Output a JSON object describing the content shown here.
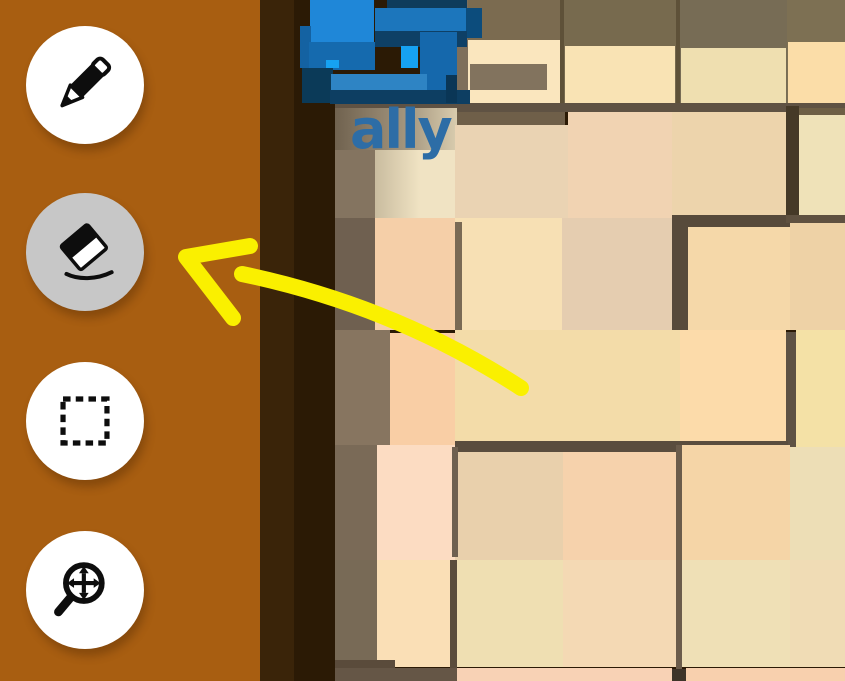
{
  "app": {
    "title": "Drawing overlay on voxel game"
  },
  "sidebar": {
    "bg": "#A85E11",
    "button_bg": "#FFFFFF",
    "active_button_bg": "#C7C7C7",
    "icon_color": "#0D0D0D",
    "tools": [
      {
        "id": "pencil",
        "label": "Draw",
        "active": false,
        "top": 26
      },
      {
        "id": "eraser",
        "label": "Erase",
        "active": true,
        "top": 193
      },
      {
        "id": "select",
        "label": "Select",
        "active": false,
        "top": 362
      },
      {
        "id": "zoom-pan",
        "label": "Zoom / Pan",
        "active": false,
        "top": 531
      }
    ]
  },
  "scene": {
    "bg": "#2B1A05",
    "player": {
      "name": "ally",
      "name_color": "#2D6DA6"
    },
    "terrain_blocks": [
      {
        "x": 260,
        "y": 0,
        "w": 34,
        "h": 681,
        "c": "#3A2409"
      },
      {
        "x": 294,
        "y": 0,
        "w": 41,
        "h": 681,
        "c": "#2B1A05"
      },
      {
        "x": 455,
        "y": 0,
        "w": 105,
        "h": 103,
        "c": "#7B6B50"
      },
      {
        "x": 560,
        "y": 0,
        "w": 116,
        "h": 103,
        "c": "#776A4E"
      },
      {
        "x": 676,
        "y": 0,
        "w": 111,
        "h": 103,
        "c": "#776C55"
      },
      {
        "x": 787,
        "y": 0,
        "w": 58,
        "h": 103,
        "c": "#7D7053"
      },
      {
        "x": 560,
        "y": 0,
        "w": 4,
        "h": 103,
        "c": "#5E5138"
      },
      {
        "x": 676,
        "y": 0,
        "w": 4,
        "h": 103,
        "c": "#5E5138"
      },
      {
        "x": 457,
        "y": 0,
        "w": 11,
        "h": 103,
        "c": "#7E6F5B"
      },
      {
        "x": 468,
        "y": 40,
        "w": 92,
        "h": 63,
        "c": "#FAE6BE"
      },
      {
        "x": 470,
        "y": 64,
        "w": 77,
        "h": 26,
        "c": "#82735E"
      },
      {
        "x": 565,
        "y": 46,
        "w": 110,
        "h": 57,
        "c": "#F9E3B4"
      },
      {
        "x": 681,
        "y": 48,
        "w": 105,
        "h": 55,
        "c": "#EFDFB0"
      },
      {
        "x": 788,
        "y": 42,
        "w": 57,
        "h": 64,
        "c": "#FBDDA8"
      },
      {
        "x": 335,
        "y": 103,
        "w": 510,
        "h": 9,
        "c": "#5F5243"
      },
      {
        "x": 455,
        "y": 112,
        "w": 110,
        "h": 13,
        "c": "#6F5F49"
      },
      {
        "x": 335,
        "y": 108,
        "w": 122,
        "h": 47,
        "c": "linear-gradient(90deg,#70624F,#A5977F 60%,#D9CCAE)"
      },
      {
        "x": 335,
        "y": 150,
        "w": 40,
        "h": 68,
        "c": "#847460"
      },
      {
        "x": 375,
        "y": 150,
        "w": 82,
        "h": 68,
        "c": "linear-gradient(90deg,#C9BC9F,#F0E3C3 55%)"
      },
      {
        "x": 455,
        "y": 125,
        "w": 113,
        "h": 93,
        "c": "#EAD3B3"
      },
      {
        "x": 568,
        "y": 112,
        "w": 104,
        "h": 106,
        "c": "#F1D3B2"
      },
      {
        "x": 672,
        "y": 112,
        "w": 114,
        "h": 106,
        "c": "#EDD4AC"
      },
      {
        "x": 786,
        "y": 106,
        "w": 13,
        "h": 116,
        "c": "#453927"
      },
      {
        "x": 799,
        "y": 108,
        "w": 46,
        "h": 7,
        "c": "#6E5F45"
      },
      {
        "x": 799,
        "y": 115,
        "w": 46,
        "h": 103,
        "c": "#EFE2B8"
      },
      {
        "x": 335,
        "y": 218,
        "w": 40,
        "h": 112,
        "c": "#6F6050"
      },
      {
        "x": 375,
        "y": 218,
        "w": 80,
        "h": 112,
        "c": "#F5CFA8"
      },
      {
        "x": 455,
        "y": 218,
        "w": 107,
        "h": 112,
        "c": "#F7E0B4"
      },
      {
        "x": 455,
        "y": 222,
        "w": 7,
        "h": 108,
        "c": "#7A6A55"
      },
      {
        "x": 562,
        "y": 218,
        "w": 110,
        "h": 112,
        "c": "#E5CDB0"
      },
      {
        "x": 672,
        "y": 215,
        "w": 16,
        "h": 118,
        "c": "#574A3B"
      },
      {
        "x": 676,
        "y": 215,
        "w": 117,
        "h": 12,
        "c": "#574A3B"
      },
      {
        "x": 688,
        "y": 227,
        "w": 102,
        "h": 103,
        "c": "#F5D8A9"
      },
      {
        "x": 786,
        "y": 215,
        "w": 59,
        "h": 8,
        "c": "#5F5140"
      },
      {
        "x": 790,
        "y": 223,
        "w": 55,
        "h": 107,
        "c": "#EED2A6"
      },
      {
        "x": 335,
        "y": 330,
        "w": 55,
        "h": 115,
        "c": "#877560"
      },
      {
        "x": 390,
        "y": 333,
        "w": 65,
        "h": 112,
        "c": "#F9CEA5"
      },
      {
        "x": 455,
        "y": 330,
        "w": 225,
        "h": 115,
        "c": "#F3DCA9"
      },
      {
        "x": 680,
        "y": 330,
        "w": 106,
        "h": 114,
        "c": "#FCDBAA"
      },
      {
        "x": 786,
        "y": 332,
        "w": 10,
        "h": 120,
        "c": "#5E5244"
      },
      {
        "x": 796,
        "y": 330,
        "w": 49,
        "h": 117,
        "c": "#F4E1A6"
      },
      {
        "x": 455,
        "y": 441,
        "w": 333,
        "h": 11,
        "c": "#5A4D3E"
      },
      {
        "x": 335,
        "y": 445,
        "w": 42,
        "h": 115,
        "c": "#7A6A57"
      },
      {
        "x": 377,
        "y": 445,
        "w": 78,
        "h": 115,
        "c": "#FCDCC2"
      },
      {
        "x": 455,
        "y": 452,
        "w": 108,
        "h": 108,
        "c": "#E9D0AC"
      },
      {
        "x": 563,
        "y": 452,
        "w": 117,
        "h": 108,
        "c": "#F6D2AC"
      },
      {
        "x": 682,
        "y": 445,
        "w": 108,
        "h": 115,
        "c": "#F5D5A7"
      },
      {
        "x": 790,
        "y": 447,
        "w": 55,
        "h": 113,
        "c": "#EDDEB6"
      },
      {
        "x": 452,
        "y": 447,
        "w": 6,
        "h": 110,
        "c": "#6F6050"
      },
      {
        "x": 676,
        "y": 445,
        "w": 6,
        "h": 227,
        "c": "#6B5C4B"
      },
      {
        "x": 335,
        "y": 560,
        "w": 42,
        "h": 107,
        "c": "#786A56"
      },
      {
        "x": 377,
        "y": 560,
        "w": 78,
        "h": 107,
        "c": "#FADFB6"
      },
      {
        "x": 450,
        "y": 560,
        "w": 7,
        "h": 108,
        "c": "#5A4D3C"
      },
      {
        "x": 457,
        "y": 560,
        "w": 106,
        "h": 107,
        "c": "#EFDFB2"
      },
      {
        "x": 563,
        "y": 560,
        "w": 113,
        "h": 107,
        "c": "#F4D9B4"
      },
      {
        "x": 682,
        "y": 560,
        "w": 108,
        "h": 107,
        "c": "#EFE0B6"
      },
      {
        "x": 790,
        "y": 560,
        "w": 55,
        "h": 107,
        "c": "#F0DCB5"
      },
      {
        "x": 335,
        "y": 660,
        "w": 60,
        "h": 21,
        "c": "#5A4B3B"
      },
      {
        "x": 335,
        "y": 668,
        "w": 122,
        "h": 13,
        "c": "#655646"
      },
      {
        "x": 457,
        "y": 668,
        "w": 215,
        "h": 13,
        "c": "#F8D2B5"
      },
      {
        "x": 686,
        "y": 668,
        "w": 159,
        "h": 13,
        "c": "#F8D0AE"
      },
      {
        "x": 672,
        "y": 669,
        "w": 14,
        "h": 12,
        "c": "#3E3429"
      }
    ],
    "character_blocks": [
      {
        "x": 387,
        "y": 0,
        "w": 80,
        "h": 8,
        "c": "#0E3C5C"
      },
      {
        "x": 310,
        "y": 0,
        "w": 64,
        "h": 44,
        "c": "#1F87D8"
      },
      {
        "x": 300,
        "y": 26,
        "w": 11,
        "h": 42,
        "c": "#1462A2"
      },
      {
        "x": 309,
        "y": 42,
        "w": 66,
        "h": 28,
        "c": "#156AAE"
      },
      {
        "x": 375,
        "y": 8,
        "w": 94,
        "h": 24,
        "c": "#1C76BC"
      },
      {
        "x": 466,
        "y": 8,
        "w": 16,
        "h": 30,
        "c": "#0C4C7C"
      },
      {
        "x": 375,
        "y": 31,
        "w": 92,
        "h": 16,
        "c": "#0E4066"
      },
      {
        "x": 420,
        "y": 32,
        "w": 37,
        "h": 71,
        "c": "#1568AC"
      },
      {
        "x": 401,
        "y": 46,
        "w": 17,
        "h": 22,
        "c": "#16A2F2"
      },
      {
        "x": 326,
        "y": 60,
        "w": 13,
        "h": 8,
        "c": "#16A2F2"
      },
      {
        "x": 302,
        "y": 68,
        "w": 31,
        "h": 35,
        "c": "#0B3A58"
      },
      {
        "x": 331,
        "y": 74,
        "w": 96,
        "h": 18,
        "c": "#2E84C4"
      },
      {
        "x": 330,
        "y": 90,
        "w": 140,
        "h": 14,
        "c": "#0D3E62"
      },
      {
        "x": 446,
        "y": 75,
        "w": 11,
        "h": 28,
        "c": "#0A3656"
      }
    ]
  },
  "annotation": {
    "color": "#FAF000",
    "stroke_width": 16,
    "arrowhead_points": "250,246 186,257 233,318",
    "tail_path": "M 242,274 Q 395,306 521,388"
  }
}
